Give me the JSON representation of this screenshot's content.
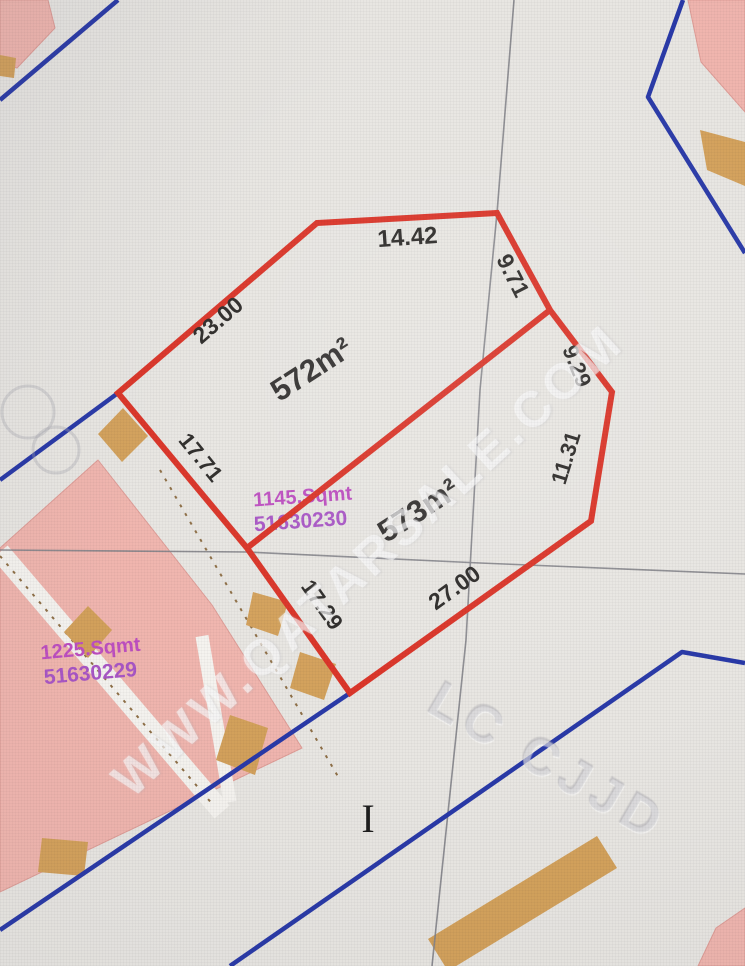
{
  "map": {
    "watermark_text": "WWW.QATARSALE.COM",
    "ghost_overlay_text": "LC CJJD",
    "cursor_glyph": "I"
  },
  "plot": {
    "upper_area": "572m²",
    "lower_area": "573m²",
    "dimensions": {
      "top": "14.42",
      "upper_left": "23.00",
      "left": "17.71",
      "lower_left": "17.29",
      "bottom": "27.00",
      "upper_right": "9.71",
      "right_upper": "9.29",
      "right_lower": "11.31"
    }
  },
  "parcels": {
    "parcel_230": {
      "area": "1145.Sqmt",
      "number": "51630230"
    },
    "parcel_229": {
      "area": "1225.Sqmt",
      "number": "51630229"
    }
  },
  "colors": {
    "background": "#e8e6e2",
    "road_white": "#f5f3ef",
    "parcel_pink": "#f1b5ad",
    "parcel_pink_edge": "#e19d96",
    "block_tan": "#d4a159",
    "boundary_red": "#df3226",
    "road_blue": "#2839ab",
    "grid_gray": "#83838a",
    "road_dash_brown": "#8f6f45",
    "dimension_text": "#2c2a28",
    "area_text": "#333130",
    "label_purple": "#c04ec4",
    "label_purple_number": "#ab55c9",
    "ghost_line": "rgba(165,165,175,0.35)",
    "cursor_black": "#1d1d1d",
    "watermark_white": "rgba(255,255,255,0.52)"
  },
  "geometry": {
    "plot_outer": "317,223 497,213 550,310 612,392 591,521 350,693 247,548 118,393",
    "plot_divider": "247,548 550,310",
    "grid_vertical": "514,0 497,213 480,390 466,640 432,966",
    "grid_horizontal": "0,550 247,552 480,563 745,574",
    "blue_top_left": "118,0 0,100",
    "blue_left": "0,480 118,393",
    "blue_top_right": "683,0 648,97 745,253",
    "blue_road_upper": "350,693 0,930",
    "blue_road_lower": "745,663 682,652 230,966",
    "pink_top_left": "0,0 48,0 55,28 17,68 0,62",
    "pink_top_right": "688,0 745,0 745,112 701,62",
    "pink_bottom_right": "716,928 745,908 745,966 698,966",
    "pink_left_main": "98,460 212,605 302,748 0,892 0,548",
    "road_strip_1": "0,552 222,812",
    "road_strip_2": "202,636 230,802",
    "road_dash_1": "0,556 214,806",
    "road_dash_2": "160,470 340,780",
    "tan_corner_left": "123,408 148,436 122,462 98,434",
    "tan_block_1": "88,606 112,630 88,658 64,632",
    "tan_road_1": "253,592 288,602 278,636 246,625",
    "tan_road_2": "300,652 336,664 324,700 290,688",
    "tan_block_2": "230,715 268,728 255,775 216,760",
    "tan_block_3": "42,838 88,842 84,876 38,872",
    "tan_top_right": "700,130 745,142 745,186 707,170",
    "tan_bar_bottom": "597,836 617,868 448,971 428,939",
    "tan_edge_top_left": "0,55 16,58 14,78 0,76"
  }
}
